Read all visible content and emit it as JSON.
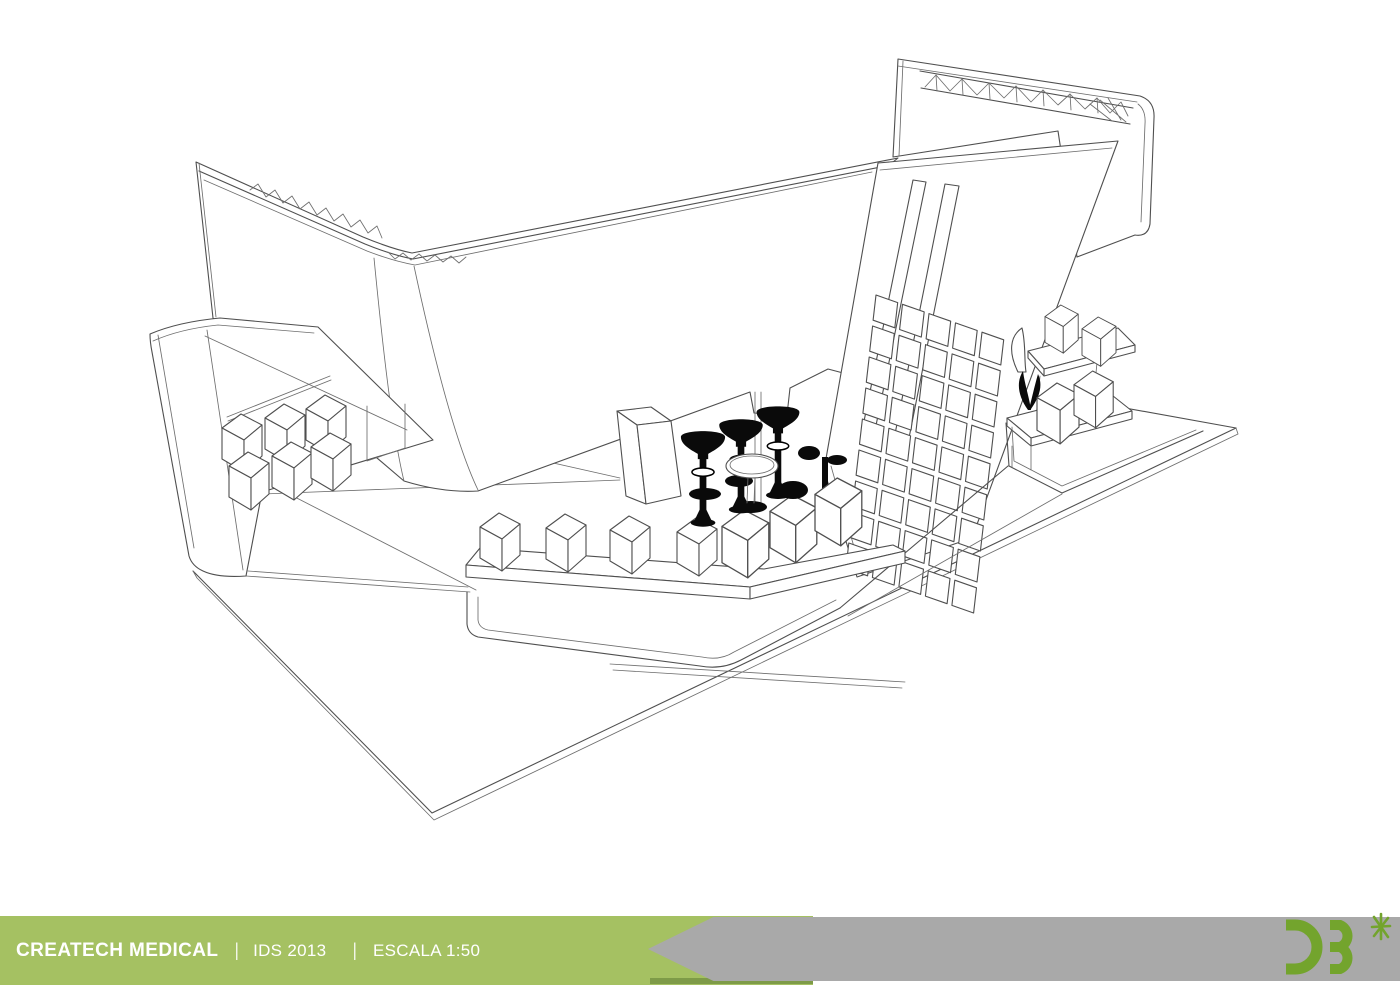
{
  "footer": {
    "project_name": "CREATECH MEDICAL",
    "separator": "|",
    "event": "IDS 2013",
    "scale": "ESCALA 1:50",
    "colors": {
      "bar_green": "#a5c162",
      "bar_green_shadow": "#7e9b48",
      "band_gray": "#a9a9a9",
      "text": "#ffffff"
    }
  },
  "logo": {
    "letters": "ƆƐ",
    "star": "*",
    "color": "#73a42d"
  },
  "drawing": {
    "title": "Exhibition stand 3D wireframe line drawing",
    "style": "monochrome sketch render",
    "stroke_color": "#4f4f4f",
    "elements": [
      "curved perimeter wall with truss channel",
      "rear header wall with truss beam",
      "slanted feature wall with square panel grid",
      "wall-mounted display cubes (left)",
      "double shelves with product cubes (right)",
      "reception counter with four cubes",
      "three bar stools and cocktail table",
      "floor platform with steps"
    ]
  }
}
